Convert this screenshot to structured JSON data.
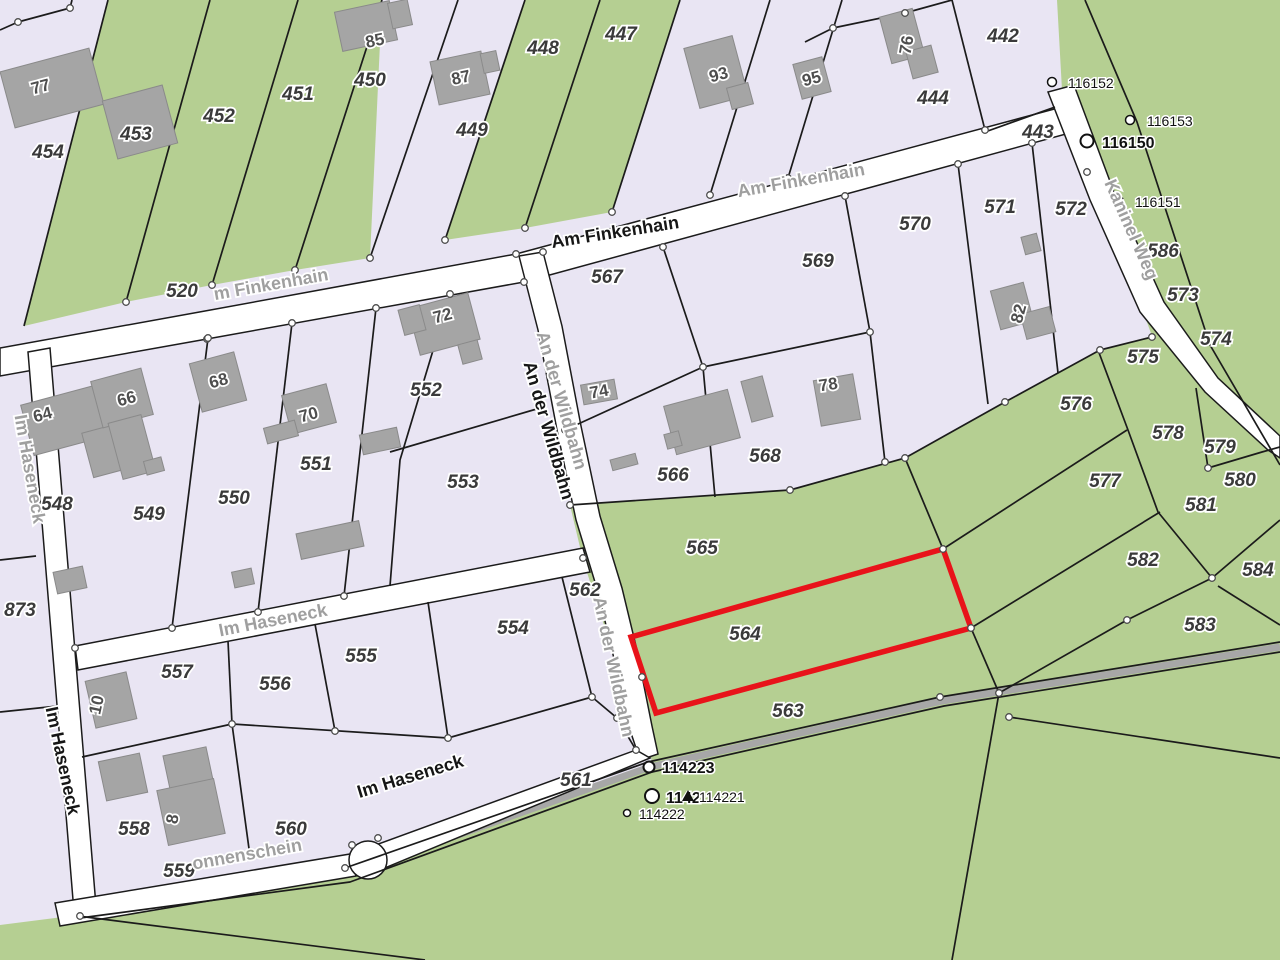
{
  "map": {
    "type": "cadastral-parcel-map",
    "highlighted_parcel": "564",
    "colors": {
      "green": "#b5cf92",
      "lavender": "#e9e5f3",
      "street_white": "#ffffff",
      "road_gray": "#a7a7a7",
      "boundary_line": "#1b1b1b",
      "building_fill": "#a5a5a5",
      "building_border": "#8a8a8a",
      "highlight_red": "#e8131a",
      "node_stroke": "#4d4d4d",
      "label_gray": "#9f9f9f",
      "label_dark": "#161616",
      "parcel_label": "#3a3a3a"
    },
    "parcel_labels": [
      {
        "text": "454",
        "x": 48,
        "y": 158
      },
      {
        "text": "453",
        "x": 136,
        "y": 140
      },
      {
        "text": "452",
        "x": 219,
        "y": 122
      },
      {
        "text": "451",
        "x": 298,
        "y": 100
      },
      {
        "text": "450",
        "x": 370,
        "y": 86
      },
      {
        "text": "449",
        "x": 472,
        "y": 136
      },
      {
        "text": "448",
        "x": 543,
        "y": 54
      },
      {
        "text": "447",
        "x": 621,
        "y": 40
      },
      {
        "text": "444",
        "x": 933,
        "y": 104
      },
      {
        "text": "442",
        "x": 1003,
        "y": 42
      },
      {
        "text": "443",
        "x": 1038,
        "y": 138
      },
      {
        "text": "520",
        "x": 182,
        "y": 297
      },
      {
        "text": "567",
        "x": 607,
        "y": 283
      },
      {
        "text": "569",
        "x": 818,
        "y": 267
      },
      {
        "text": "570",
        "x": 915,
        "y": 230
      },
      {
        "text": "571",
        "x": 1000,
        "y": 213
      },
      {
        "text": "572",
        "x": 1071,
        "y": 215
      },
      {
        "text": "586",
        "x": 1163,
        "y": 257
      },
      {
        "text": "573",
        "x": 1183,
        "y": 301
      },
      {
        "text": "574",
        "x": 1216,
        "y": 345
      },
      {
        "text": "575",
        "x": 1143,
        "y": 363
      },
      {
        "text": "576",
        "x": 1076,
        "y": 410
      },
      {
        "text": "577",
        "x": 1105,
        "y": 487
      },
      {
        "text": "578",
        "x": 1168,
        "y": 439
      },
      {
        "text": "579",
        "x": 1220,
        "y": 453
      },
      {
        "text": "580",
        "x": 1240,
        "y": 486
      },
      {
        "text": "581",
        "x": 1201,
        "y": 511
      },
      {
        "text": "582",
        "x": 1143,
        "y": 566
      },
      {
        "text": "583",
        "x": 1200,
        "y": 631
      },
      {
        "text": "584",
        "x": 1258,
        "y": 576
      },
      {
        "text": "548",
        "x": 57,
        "y": 510
      },
      {
        "text": "549",
        "x": 149,
        "y": 520
      },
      {
        "text": "550",
        "x": 234,
        "y": 504
      },
      {
        "text": "551",
        "x": 316,
        "y": 470
      },
      {
        "text": "552",
        "x": 426,
        "y": 396
      },
      {
        "text": "553",
        "x": 463,
        "y": 488
      },
      {
        "text": "554",
        "x": 513,
        "y": 634
      },
      {
        "text": "555",
        "x": 361,
        "y": 662
      },
      {
        "text": "556",
        "x": 275,
        "y": 690
      },
      {
        "text": "557",
        "x": 177,
        "y": 678
      },
      {
        "text": "558",
        "x": 134,
        "y": 835
      },
      {
        "text": "559",
        "x": 179,
        "y": 877
      },
      {
        "text": "560",
        "x": 291,
        "y": 835
      },
      {
        "text": "561",
        "x": 576,
        "y": 786
      },
      {
        "text": "562",
        "x": 585,
        "y": 596
      },
      {
        "text": "563",
        "x": 788,
        "y": 717
      },
      {
        "text": "564",
        "x": 745,
        "y": 640
      },
      {
        "text": "565",
        "x": 702,
        "y": 554
      },
      {
        "text": "566",
        "x": 673,
        "y": 481
      },
      {
        "text": "568",
        "x": 765,
        "y": 462
      },
      {
        "text": "873",
        "x": 20,
        "y": 616
      }
    ],
    "street_labels": [
      {
        "text": "m Finkenhain",
        "x": 272,
        "y": 290,
        "rot": -10,
        "cls": "gray"
      },
      {
        "text": "Am Finkenhain",
        "x": 802,
        "y": 186,
        "rot": -10,
        "cls": "gray"
      },
      {
        "text": "Am Finkenhain",
        "x": 616,
        "y": 238,
        "rot": -9,
        "cls": "bold"
      },
      {
        "text": "An der Wildbahn",
        "x": 556,
        "y": 402,
        "rot": 74,
        "cls": "gray"
      },
      {
        "text": "An der Wildbahn",
        "x": 543,
        "y": 432,
        "rot": 74,
        "cls": "bold"
      },
      {
        "text": "An der Wildbahn",
        "x": 608,
        "y": 668,
        "rot": 78,
        "cls": "gray"
      },
      {
        "text": "Im Haseneck",
        "x": 24,
        "y": 470,
        "rot": 80,
        "cls": "gray"
      },
      {
        "text": "Im Haseneck",
        "x": 57,
        "y": 762,
        "rot": 78,
        "cls": "bold"
      },
      {
        "text": "Im Haseneck",
        "x": 274,
        "y": 626,
        "rot": -11,
        "cls": "gray"
      },
      {
        "text": "Im Haseneck",
        "x": 412,
        "y": 782,
        "rot": -17,
        "cls": "bold"
      },
      {
        "text": "onnenschein",
        "x": 248,
        "y": 860,
        "rot": -10,
        "cls": "gray"
      },
      {
        "text": "Kaninel Weg",
        "x": 1126,
        "y": 232,
        "rot": 66,
        "cls": "gray"
      }
    ],
    "building_labels": [
      {
        "text": "77",
        "x": 42,
        "y": 92,
        "rot": -15
      },
      {
        "text": "85",
        "x": 376,
        "y": 46,
        "rot": -12
      },
      {
        "text": "87",
        "x": 462,
        "y": 83,
        "rot": -12
      },
      {
        "text": "93",
        "x": 720,
        "y": 80,
        "rot": -15
      },
      {
        "text": "95",
        "x": 813,
        "y": 84,
        "rot": -15
      },
      {
        "text": "76",
        "x": 912,
        "y": 46,
        "rot": -80
      },
      {
        "text": "82",
        "x": 1024,
        "y": 315,
        "rot": -75
      },
      {
        "text": "64",
        "x": 44,
        "y": 420,
        "rot": -15
      },
      {
        "text": "66",
        "x": 128,
        "y": 404,
        "rot": -15
      },
      {
        "text": "68",
        "x": 220,
        "y": 386,
        "rot": -15
      },
      {
        "text": "70",
        "x": 310,
        "y": 420,
        "rot": -15
      },
      {
        "text": "72",
        "x": 444,
        "y": 321,
        "rot": -15
      },
      {
        "text": "74",
        "x": 600,
        "y": 397,
        "rot": -10
      },
      {
        "text": "78",
        "x": 829,
        "y": 390,
        "rot": -8
      },
      {
        "text": "10",
        "x": 102,
        "y": 706,
        "rot": -78
      },
      {
        "text": "8",
        "x": 178,
        "y": 820,
        "rot": -80
      }
    ],
    "survey_markers": [
      {
        "label": "116152",
        "cx": 1052,
        "cy": 82,
        "r": 4.5,
        "lx": 1068,
        "ly": 88,
        "bold": false
      },
      {
        "label": "116153",
        "cx": 1130,
        "cy": 120,
        "r": 4.5,
        "lx": 1147,
        "ly": 126,
        "bold": false
      },
      {
        "label": "116150",
        "cx": 1087,
        "cy": 141,
        "r": 6.5,
        "lx": 1102,
        "ly": 148,
        "bold": true
      },
      {
        "label": "116151",
        "cx": 1119,
        "cy": 201,
        "r": 4.5,
        "lx": 1135,
        "ly": 207,
        "bold": false
      },
      {
        "label": "114223",
        "cx": 649,
        "cy": 767,
        "r": 5.5,
        "lx": 662,
        "ly": 773,
        "bold": true
      },
      {
        "label": "1142",
        "cx": 652,
        "cy": 796,
        "r": 7,
        "lx": 666,
        "ly": 803,
        "bold": true
      },
      {
        "label": "114221",
        "cx": -1,
        "cy": -1,
        "r": 0,
        "lx": 699,
        "ly": 802,
        "bold": false,
        "triangle_x": 688,
        "triangle_y": 796
      },
      {
        "label": "114222",
        "cx": 627,
        "cy": 813,
        "r": 3.5,
        "lx": 639,
        "ly": 819,
        "bold": false
      }
    ]
  }
}
